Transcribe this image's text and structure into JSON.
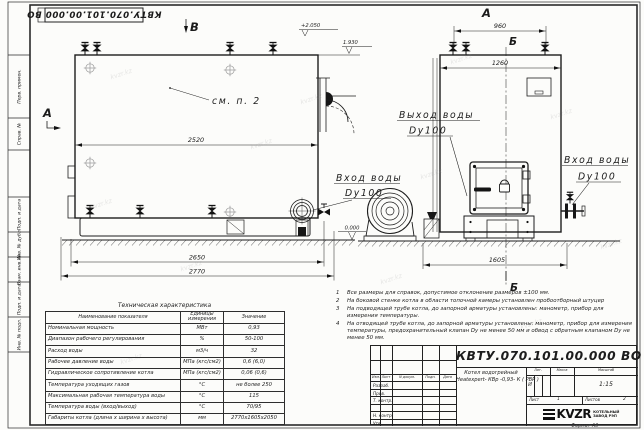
{
  "doc": {
    "number": "КВТУ.070.101.00.000  ВО",
    "format_label": "Формат  А3"
  },
  "watermark": "kvzr.kz",
  "frame": {
    "margin_labels": [
      "Перв. примен.",
      "Справ. №",
      "Подп. и дата",
      "Инв. № дубл.",
      "Взам. инв. №",
      "Подп. и дата",
      "Инв. № подл."
    ]
  },
  "views": {
    "marker_a_left": "А",
    "marker_v_top": "В",
    "marker_a_right": "А",
    "marker_b": "Б",
    "see_ref": "см. п. 2"
  },
  "dimensions": {
    "d2520": "2520",
    "d2650": "2650",
    "d2770": "2770",
    "d960": "960",
    "d1260": "1260",
    "d1605": "1605"
  },
  "elevations": {
    "top": "+2.050",
    "mid": "1.930",
    "zero": "0.000"
  },
  "labels": {
    "outlet1": "Выход воды",
    "outlet2": "Dy100",
    "inlet1": "Вход воды",
    "inlet2": "Dy100",
    "inlet_r1": "Вход воды",
    "inlet_r2": "Dy100"
  },
  "notes": {
    "items": [
      {
        "num": "1",
        "text": "Все размеры для справок, допустимое отклонение размеров ±100 мм."
      },
      {
        "num": "2",
        "text": "На боковой стенке котла в области топочной камеры установлен пробоотборный штуцер"
      },
      {
        "num": "3",
        "text": "На  подводящей трубе котла, до запорной арматуры установлены: манометр, прибор для измерения температуры."
      },
      {
        "num": "4",
        "text": "На отводящей трубе котла, до запорной арматуры установлены: манометр, прибор для измерения температуры, предохранительный клапан Dу не менее 50 мм и обвод с обратным клапаном Dу не менее 50 мм."
      }
    ]
  },
  "tech_table": {
    "title": "Техническая характеристика",
    "headers": {
      "name": "Наименование показателя",
      "units": "Единицы измерения",
      "value": "Значение"
    },
    "rows": [
      [
        "Номинальная мощность",
        "МВт",
        "0,93"
      ],
      [
        "Диапазон рабочего регулирования",
        "%",
        "50-100"
      ],
      [
        "Расход воды",
        "м3/ч",
        "32"
      ],
      [
        "Рабочее давление воды",
        "МПа (кгс/см2)",
        "0,6 (6,0)"
      ],
      [
        "Гидравлическое сопротивление котла",
        "МПа (кгс/см2)",
        "0,06 (0,6)"
      ],
      [
        "Температура уходящих газов",
        "°С",
        "не более 250"
      ],
      [
        "Максимальная рабочая температура воды",
        "°С",
        "115"
      ],
      [
        "Температура воды (вход/выход)",
        "°С",
        "70/95"
      ],
      [
        "Габариты котла (длина х ширина х высота)",
        "мм",
        "2770х1605х2050"
      ]
    ]
  },
  "title_block": {
    "header_cols": [
      "Изм.",
      "Лист",
      "N докум.",
      "Подп.",
      "Дата"
    ],
    "row_labels": [
      "Разраб.",
      "Пров.",
      "Т. контр.",
      "",
      "Н. контр.",
      "Утв."
    ],
    "name_line1": "Котел водогрейный",
    "name_line2": "Heatexpert- КВр -0,93- К ( РВР )",
    "lit_header": "Лит.",
    "lit_value": "И",
    "mass_header": "Масса",
    "scale_header": "Масштаб",
    "scale_value": "1:15",
    "sheet_label": "Лист",
    "sheet_value": "1",
    "sheets_label": "Листов",
    "sheets_value": "2",
    "company_logo": "KVZR",
    "company_line1": "КОТЕЛЬНЫЙ",
    "company_line2": "ЗАВОД РЭП"
  }
}
